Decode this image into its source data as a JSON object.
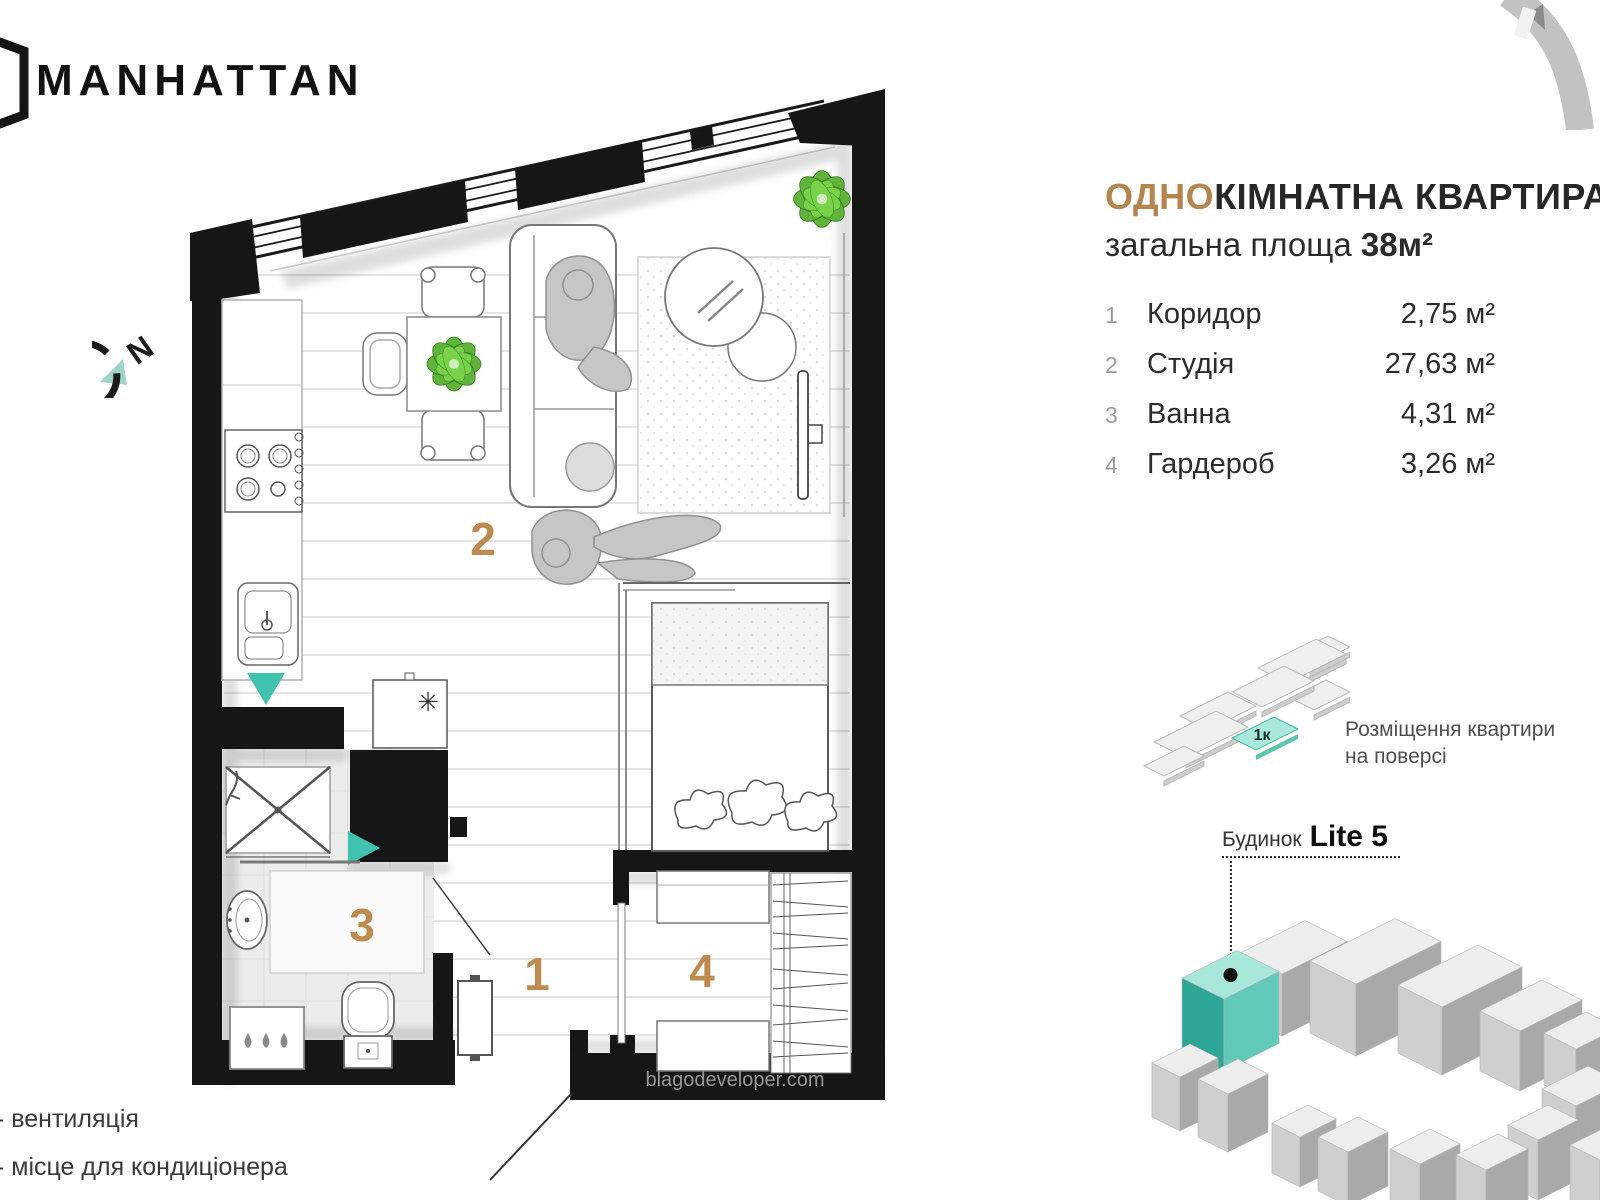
{
  "brand": {
    "name": "MANHATTAN"
  },
  "title": {
    "highlight": "ОДНО",
    "rest": "КІМНАТНА КВАРТИРА",
    "area_label": "загальна площа ",
    "area_value": "38м²"
  },
  "rooms": [
    {
      "num": "1",
      "name": "Коридор",
      "area": "2,75 м²"
    },
    {
      "num": "2",
      "name": "Студія",
      "area": "27,63 м²"
    },
    {
      "num": "3",
      "name": "Ванна",
      "area": "4,31 м²"
    },
    {
      "num": "4",
      "name": "Гардероб",
      "area": "3,26 м²"
    }
  ],
  "plan": {
    "compass": "N",
    "room1": "1",
    "room2": "2",
    "room3": "3",
    "room4": "4",
    "boiler": "✳",
    "watermark": "blagodeveloper.com"
  },
  "floor_diagram": {
    "unit": "1к",
    "caption1": "Розміщення квартири",
    "caption2": "на поверсі"
  },
  "building_diagram": {
    "prefix": "Будинок",
    "name": "Lite 5"
  },
  "legend": [
    "- вентиляція",
    "- місце для кондиціонера"
  ],
  "colors": {
    "accent": "#b5854f",
    "teal": "#3fc3ae",
    "wall": "#161616"
  }
}
